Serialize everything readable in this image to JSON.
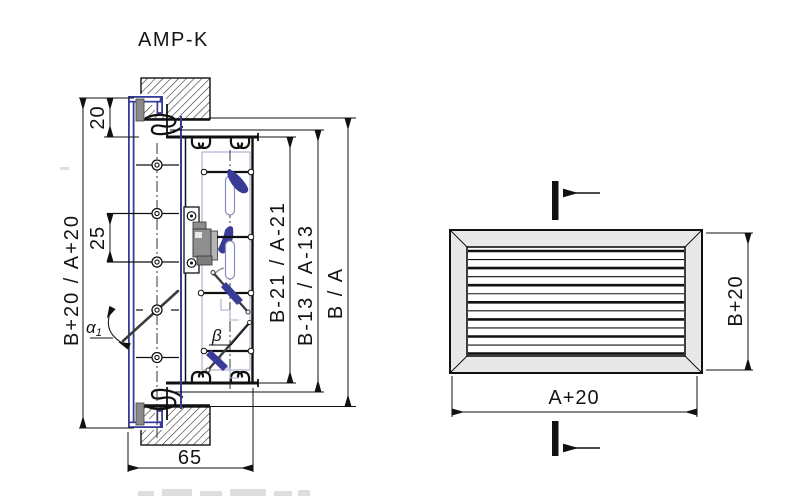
{
  "title": "AMP-K",
  "colors": {
    "accent_blue": "#383c96",
    "frame_gray": "#e8e8e8",
    "gear_gray": "#8f8f8f",
    "line": "#111111"
  },
  "section_view": {
    "dim_overall": "B+20 / A+20",
    "dim_flange": "20",
    "dim_blade_pitch": "25",
    "dim_inner_front": "B-21 / A-21",
    "dim_inner_rear": "B-13 / A-13",
    "dim_duct": "B / A",
    "dim_depth": "65",
    "angle_front": "α",
    "angle_front_sub": "1",
    "angle_rear": "β"
  },
  "front_view": {
    "dim_width": "A+20",
    "dim_height": "B+20",
    "louver_line_count": 13
  }
}
